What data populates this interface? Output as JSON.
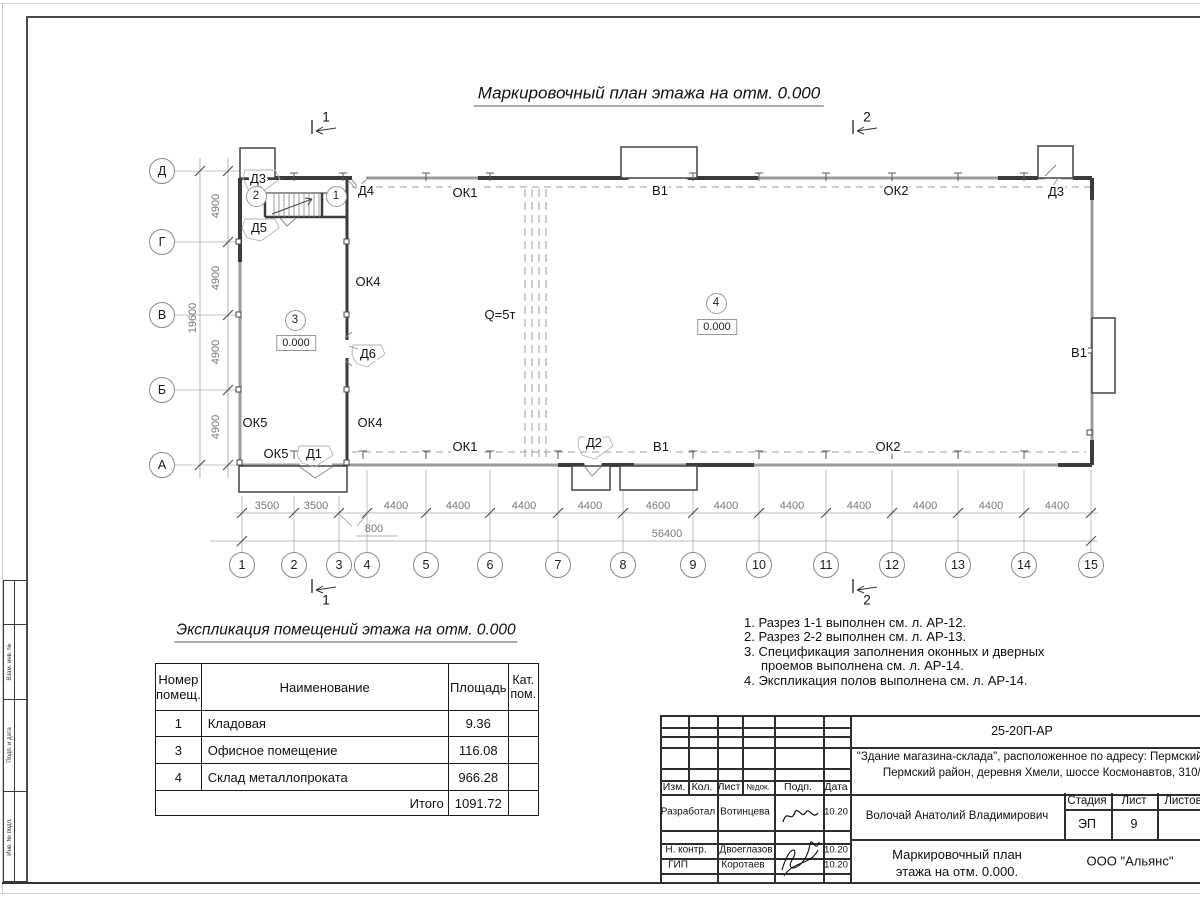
{
  "plan": {
    "title": "Маркировочный план этажа на отм. 0.000",
    "row_axes": [
      "Д",
      "Г",
      "В",
      "Б",
      "А"
    ],
    "col_axes": [
      "1",
      "2",
      "3",
      "4",
      "5",
      "6",
      "7",
      "8",
      "9",
      "10",
      "11",
      "12",
      "13",
      "14",
      "15"
    ],
    "dims_x": [
      "3500",
      "3500",
      "4400",
      "4400",
      "4400",
      "4400",
      "4600",
      "4400",
      "4400",
      "4400",
      "4400",
      "4400",
      "4400"
    ],
    "dim_x_offset": "800",
    "dim_x_total": "56400",
    "dims_y": [
      "4900",
      "4900",
      "4900",
      "4900"
    ],
    "dim_y_total": "19600",
    "sections": {
      "s1": "1",
      "s2": "2"
    },
    "room_numbers": [
      "2",
      "1",
      "3",
      "4"
    ],
    "labels": {
      "ok1": "ОК1",
      "ok2": "ОК2",
      "ok4": "ОК4",
      "ok5": "ОК5",
      "v1": "В1",
      "d1": "Д1",
      "d2": "Д2",
      "d3": "Д3",
      "d4": "Д4",
      "d5": "Д5",
      "d6": "Д6",
      "crane_capacity": "Q=5т",
      "elevation": "0.000"
    }
  },
  "explication": {
    "title": "Экспликация помещений этажа на отм. 0.000",
    "headers": [
      "Номер помещ.",
      "Наименование",
      "Площадь",
      "Кат. пом."
    ],
    "rows": [
      [
        "1",
        "Кладовая",
        "9.36",
        ""
      ],
      [
        "3",
        "Офисное помещение",
        "116.08",
        ""
      ],
      [
        "4",
        "Склад металлопроката",
        "966.28",
        ""
      ]
    ],
    "total_label": "Итого",
    "total_value": "1091.72"
  },
  "notes": {
    "items": [
      "1. Разрез 1-1 выполнен см. л. АР-12.",
      "2. Разрез 2-2 выполнен см. л. АР-13.",
      "3. Спецификация заполнения оконных и дверных проемов выполнена см. л. АР-14.",
      "4. Экспликация полов выполнена см. л. АР-14."
    ]
  },
  "title_block": {
    "doc_number": "25-20П-АР",
    "project_line1": "\"Здание магазина-склада\", расположенное по адресу: Пермский край,",
    "project_line2": "Пермский район, деревня Хмели, шоссе Космонавтов, 310/9",
    "header_cells": [
      "Изм.",
      "Кол.",
      "Лист",
      "№док.",
      "Подп.",
      "Дата"
    ],
    "roles": [
      {
        "role": "Разработал",
        "name": "Вотинцева",
        "date": "10.20"
      },
      {
        "role": "Н. контр.",
        "name": "Двоеглазов",
        "date": "10.20"
      },
      {
        "role": "ГИП",
        "name": "Коротаев",
        "date": "10.20"
      }
    ],
    "supervisor": "Волочай Анатолий Владимирович",
    "stage_label": "Стадия",
    "sheet_label": "Лист",
    "sheets_label": "Листов",
    "stage": "ЭП",
    "sheet_number": "9",
    "sheets_total": "",
    "drawing_title_line1": "Маркировочный план",
    "drawing_title_line2": "этажа на отм. 0.000.",
    "company": "ООО \"Альянс\""
  },
  "side_stamp": {
    "cells": [
      "Взам. инв. №",
      "Подп. и дата",
      "Инв. № подл."
    ]
  }
}
